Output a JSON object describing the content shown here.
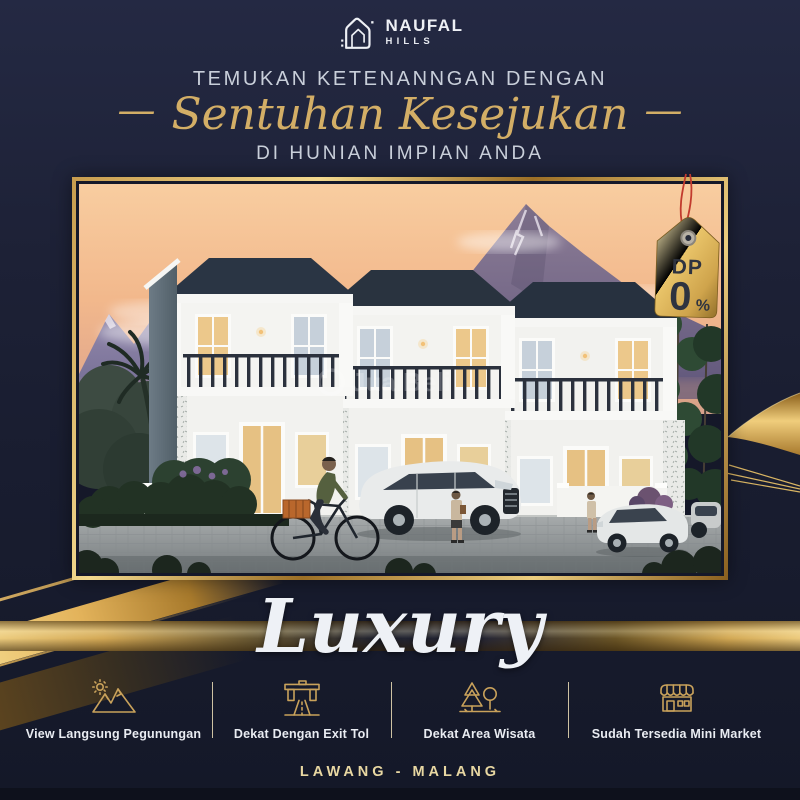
{
  "brand": {
    "name": "NAUFAL",
    "sub": "HILLS"
  },
  "headline": {
    "top": "TEMUKAN KETENANNGAN DENGAN",
    "dash": "—",
    "script": "Sentuhan Kesejukan",
    "bottom": "DI HUNIAN IMPIAN ANDA"
  },
  "promo_tag": {
    "label": "DP",
    "value": "0",
    "unit": "%"
  },
  "hero": {
    "watermark": "JualBeli"
  },
  "tagline": "Luxury",
  "features": [
    {
      "icon": "mountain-sun-icon",
      "label": "View Langsung Pegunungan"
    },
    {
      "icon": "toll-exit-icon",
      "label": "Dekat Dengan Exit Tol"
    },
    {
      "icon": "tourist-area-icon",
      "label": "Dekat Area Wisata"
    },
    {
      "icon": "mini-market-icon",
      "label": "Sudah Tersedia Mini Market"
    }
  ],
  "footer": {
    "location": "LAWANG - MALANG"
  },
  "colors": {
    "background": "#1b1f33",
    "gold": "#d4ab5e",
    "gold_light": "#f3d98b",
    "cream_text": "#e8d7a2",
    "light_text": "#c9cfda",
    "tag_text": "#2e3340",
    "string_red": "#c23b2e"
  }
}
